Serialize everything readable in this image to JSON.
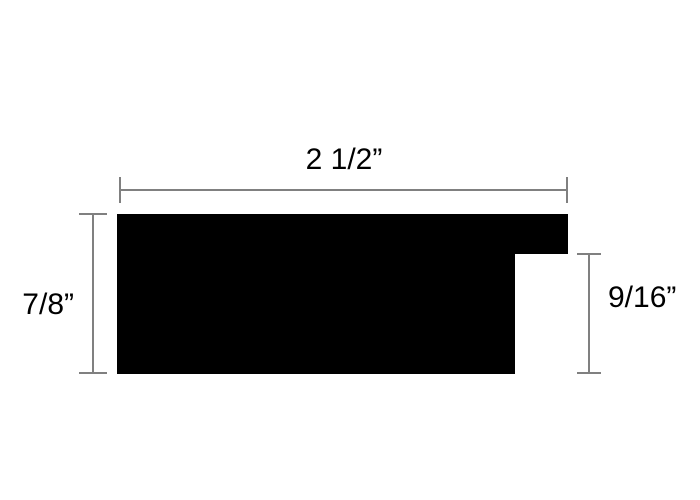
{
  "diagram": {
    "description": "moulding profile cross-section dimension drawing",
    "colors": {
      "background": "#ffffff",
      "shape": "#000000",
      "dimension_line": "#808080",
      "text": "#000000"
    },
    "dimensions": {
      "width": {
        "label": "2 1/2”",
        "value_inches": 2.5
      },
      "height": {
        "label": "7/8”",
        "value_inches": 0.875
      },
      "rabbet": {
        "label": "9/16”",
        "value_inches": 0.5625
      }
    }
  }
}
